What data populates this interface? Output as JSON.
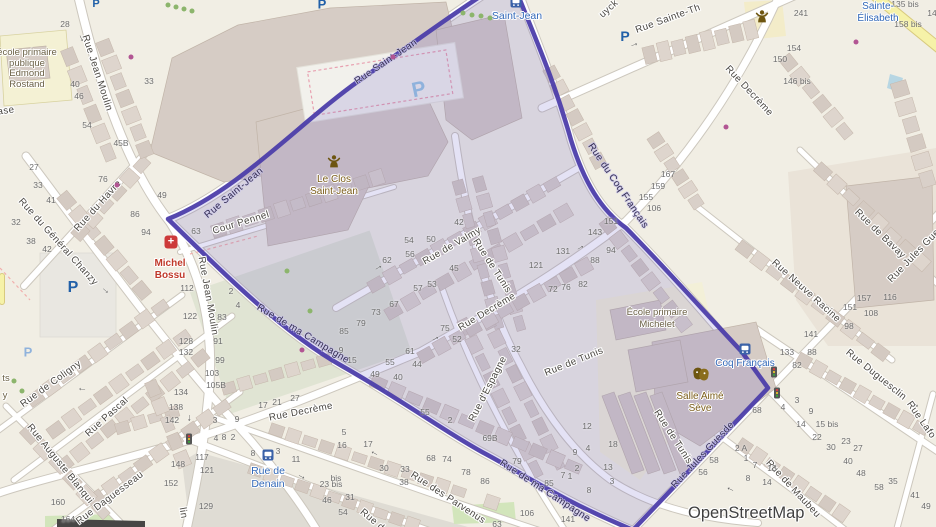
{
  "attribution": "OpenStreetMap",
  "colors": {
    "boundary": "#4c3eaa",
    "boundary_fill": "rgba(95,85,195,0.18)",
    "street": "#4a4742",
    "on_boundary": "#342e52",
    "number": "#6e6e6e",
    "transit": "#3268b8",
    "school": "#6b6146",
    "poi": "#7a5c18",
    "pharmacy": "#c0392b",
    "parking": "#2160a8",
    "parking_light": "#8fb2dc",
    "tree": "#8cb56c",
    "shop": "#b25593",
    "arrow": "#575757",
    "road": "#ffffff",
    "road_casing": "#ccc7bd",
    "building": "#d9d0c9",
    "yellow_road": "#f6f2a8",
    "water": "#b7d6e3"
  },
  "glyphs": {
    "parking": "P",
    "pharmacy_cross": "+",
    "arrow": "→"
  },
  "street_labels": [
    {
      "t": "Rue Jean Moulin",
      "x": 97,
      "y": 73,
      "r": 72
    },
    {
      "t": "Rue Jean Moulin",
      "x": 208,
      "y": 296,
      "r": 80
    },
    {
      "t": "lin",
      "x": 183,
      "y": 513,
      "r": 80
    },
    {
      "t": "Rue Saint-Jean",
      "x": 234,
      "y": 193,
      "r": -40,
      "k": "bd"
    },
    {
      "t": "Rue Saint-Jean",
      "x": 386,
      "y": 62,
      "r": -34,
      "k": "bd"
    },
    {
      "t": "Rue Sainte-Th",
      "x": 668,
      "y": 19,
      "r": -20
    },
    {
      "t": "uyck",
      "x": 609,
      "y": 9,
      "r": -42
    },
    {
      "t": "Rue Decrème",
      "x": 749,
      "y": 91,
      "r": 47
    },
    {
      "t": "Rue Decrème",
      "x": 487,
      "y": 312,
      "r": -31
    },
    {
      "t": "Rue Decrème",
      "x": 301,
      "y": 412,
      "r": -11
    },
    {
      "t": "Rue de Valmy",
      "x": 452,
      "y": 246,
      "r": -30
    },
    {
      "t": "Rue de Tunis",
      "x": 492,
      "y": 266,
      "r": 57
    },
    {
      "t": "Rue de Tunis",
      "x": 574,
      "y": 362,
      "r": -22
    },
    {
      "t": "Rue de Tunis",
      "x": 673,
      "y": 437,
      "r": 57
    },
    {
      "t": "Rue d'Espagne",
      "x": 488,
      "y": 389,
      "r": -63
    },
    {
      "t": "Cour Pennel",
      "x": 241,
      "y": 223,
      "r": -17
    },
    {
      "t": "Rue du Havre",
      "x": 98,
      "y": 206,
      "r": -48
    },
    {
      "t": "Rue du Général Chanzy",
      "x": 58,
      "y": 242,
      "r": 48
    },
    {
      "t": "Rue de Coligny",
      "x": 51,
      "y": 384,
      "r": -36
    },
    {
      "t": "Rue Pascal",
      "x": 107,
      "y": 417,
      "r": -42
    },
    {
      "t": "Rue Auguste Blanqui",
      "x": 60,
      "y": 464,
      "r": 51
    },
    {
      "t": "Rue Daguesseau",
      "x": 110,
      "y": 498,
      "r": -37
    },
    {
      "t": "Rue des Parvenus",
      "x": 448,
      "y": 498,
      "r": 33
    },
    {
      "t": "Rue Duguesclin",
      "x": 876,
      "y": 375,
      "r": 39
    },
    {
      "t": "Rue Lafo",
      "x": 921,
      "y": 420,
      "r": 55
    },
    {
      "t": "Rue de Maubeu",
      "x": 793,
      "y": 489,
      "r": 47
    },
    {
      "t": "Rue Neuve Racine",
      "x": 806,
      "y": 291,
      "r": 42
    },
    {
      "t": "Rue de Bavay",
      "x": 880,
      "y": 234,
      "r": 44
    },
    {
      "t": "Rue Jules Gue",
      "x": 914,
      "y": 256,
      "r": -46
    },
    {
      "t": "Rue de ma Campagne",
      "x": 303,
      "y": 334,
      "r": 31,
      "k": "bd"
    },
    {
      "t": "Rue de ma Campagne",
      "x": 545,
      "y": 491,
      "r": 33,
      "k": "bd"
    },
    {
      "t": "Rue du Coq Français",
      "x": 618,
      "y": 186,
      "r": 56,
      "k": "bd"
    },
    {
      "t": "Rue Jules Guesde",
      "x": 703,
      "y": 455,
      "r": -47,
      "k": "bd"
    },
    {
      "t": "Rue d",
      "x": 372,
      "y": 520,
      "r": 40
    },
    {
      "t": "ase",
      "x": 6,
      "y": 111,
      "r": -8
    }
  ],
  "house_numbers": [
    [
      "28",
      65,
      24
    ],
    [
      "33",
      149,
      81
    ],
    [
      "40",
      75,
      84
    ],
    [
      "46",
      79,
      96
    ],
    [
      "54",
      87,
      125
    ],
    [
      "45B",
      121,
      143
    ],
    [
      "27",
      34,
      167
    ],
    [
      "33",
      38,
      185
    ],
    [
      "41",
      51,
      200
    ],
    [
      "76",
      103,
      179
    ],
    [
      "49",
      162,
      195
    ],
    [
      "86",
      135,
      214
    ],
    [
      "94",
      146,
      232
    ],
    [
      "63",
      196,
      231
    ],
    [
      "32",
      16,
      222
    ],
    [
      "38",
      31,
      241
    ],
    [
      "42",
      47,
      249
    ],
    [
      "112",
      187,
      288
    ],
    [
      "122",
      190,
      316
    ],
    [
      "83",
      222,
      317
    ],
    [
      "128",
      186,
      341
    ],
    [
      "132",
      186,
      352
    ],
    [
      "2",
      231,
      291
    ],
    [
      "4",
      238,
      305
    ],
    [
      "91",
      218,
      341
    ],
    [
      "99",
      220,
      360
    ],
    [
      "103",
      212,
      373
    ],
    [
      "105B",
      216,
      385
    ],
    [
      "134",
      181,
      392
    ],
    [
      "138",
      176,
      407
    ],
    [
      "142",
      172,
      420
    ],
    [
      "148",
      178,
      464
    ],
    [
      "152",
      171,
      483
    ],
    [
      "160",
      58,
      502
    ],
    [
      "164",
      68,
      519
    ],
    [
      "117",
      202,
      457
    ],
    [
      "121",
      207,
      470
    ],
    [
      "129",
      206,
      506
    ],
    [
      "17",
      263,
      405
    ],
    [
      "21",
      277,
      402
    ],
    [
      "27",
      295,
      398
    ],
    [
      "3",
      215,
      420
    ],
    [
      "9",
      237,
      419
    ],
    [
      "4",
      216,
      438
    ],
    [
      "8",
      224,
      437
    ],
    [
      "2",
      233,
      437
    ],
    [
      "8",
      253,
      453
    ],
    [
      "3",
      278,
      451
    ],
    [
      "11",
      296,
      459
    ],
    [
      "23 bis",
      331,
      484
    ],
    [
      "46",
      327,
      500
    ],
    [
      "31",
      350,
      497
    ],
    [
      "54",
      343,
      512
    ],
    [
      "5",
      344,
      432
    ],
    [
      "16",
      342,
      445
    ],
    [
      "17",
      368,
      444
    ],
    [
      "30",
      384,
      468
    ],
    [
      "33",
      405,
      469
    ],
    [
      "38",
      404,
      482
    ],
    [
      "bis",
      336,
      478
    ],
    [
      "68",
      431,
      458
    ],
    [
      "74",
      447,
      459
    ],
    [
      "78",
      466,
      472
    ],
    [
      "86",
      485,
      481
    ],
    [
      "63",
      497,
      524
    ],
    [
      "106",
      527,
      513
    ],
    [
      "141",
      568,
      519
    ],
    [
      "42",
      459,
      222
    ],
    [
      "54",
      409,
      240
    ],
    [
      "50",
      431,
      239
    ],
    [
      "56",
      410,
      254
    ],
    [
      "62",
      387,
      260
    ],
    [
      "45",
      454,
      268
    ],
    [
      "57",
      418,
      288
    ],
    [
      "53",
      432,
      284
    ],
    [
      "67",
      394,
      304
    ],
    [
      "73",
      376,
      312
    ],
    [
      "79",
      361,
      323
    ],
    [
      "85",
      344,
      331
    ],
    [
      "9",
      341,
      350
    ],
    [
      "15",
      352,
      360
    ],
    [
      "55",
      390,
      362
    ],
    [
      "44",
      417,
      364
    ],
    [
      "49",
      375,
      374
    ],
    [
      "40",
      398,
      377
    ],
    [
      "75",
      445,
      328
    ],
    [
      "52",
      457,
      339
    ],
    [
      "61",
      410,
      351
    ],
    [
      "55",
      425,
      412
    ],
    [
      "2",
      450,
      420
    ],
    [
      "69B",
      490,
      438
    ],
    [
      "79",
      517,
      461
    ],
    [
      "85",
      549,
      483
    ],
    [
      "32",
      516,
      349
    ],
    [
      "12",
      587,
      426
    ],
    [
      "9",
      575,
      452
    ],
    [
      "4",
      588,
      448
    ],
    [
      "2",
      577,
      468
    ],
    [
      "1",
      570,
      476
    ],
    [
      "7",
      563,
      475
    ],
    [
      "18",
      613,
      444
    ],
    [
      "13",
      608,
      467
    ],
    [
      "3",
      612,
      481
    ],
    [
      "8",
      589,
      490
    ],
    [
      "167",
      668,
      174
    ],
    [
      "159",
      658,
      186
    ],
    [
      "155",
      646,
      197
    ],
    [
      "106",
      654,
      208
    ],
    [
      "151",
      611,
      221
    ],
    [
      "143",
      595,
      232
    ],
    [
      "131",
      563,
      251
    ],
    [
      "121",
      536,
      265
    ],
    [
      "94",
      611,
      250
    ],
    [
      "88",
      595,
      260
    ],
    [
      "82",
      583,
      284
    ],
    [
      "72",
      553,
      289
    ],
    [
      "76",
      566,
      287
    ],
    [
      "241",
      801,
      13
    ],
    [
      "154",
      794,
      48
    ],
    [
      "150",
      780,
      59
    ],
    [
      "146 bis",
      797,
      81
    ],
    [
      "135 bis",
      905,
      4
    ],
    [
      "14",
      932,
      13
    ],
    [
      "158 bis",
      908,
      24
    ],
    [
      "157",
      864,
      298
    ],
    [
      "151",
      850,
      307
    ],
    [
      "116",
      890,
      297
    ],
    [
      "108",
      871,
      313
    ],
    [
      "98",
      849,
      326
    ],
    [
      "141",
      811,
      334
    ],
    [
      "133",
      787,
      352
    ],
    [
      "88",
      812,
      352
    ],
    [
      "82",
      797,
      365
    ],
    [
      "68",
      757,
      410
    ],
    [
      "58",
      714,
      460
    ],
    [
      "56",
      703,
      472
    ],
    [
      "3",
      797,
      400
    ],
    [
      "4",
      783,
      407
    ],
    [
      "9",
      811,
      411
    ],
    [
      "14",
      801,
      424
    ],
    [
      "15 bis",
      827,
      424
    ],
    [
      "22",
      817,
      437
    ],
    [
      "23",
      846,
      441
    ],
    [
      "30",
      831,
      447
    ],
    [
      "27",
      858,
      448
    ],
    [
      "40",
      848,
      461
    ],
    [
      "48",
      861,
      473
    ],
    [
      "58",
      879,
      487
    ],
    [
      "35",
      893,
      481
    ],
    [
      "41",
      915,
      495
    ],
    [
      "49",
      926,
      506
    ],
    [
      "2 A",
      741,
      448
    ],
    [
      "1",
      746,
      458
    ],
    [
      "7",
      755,
      465
    ],
    [
      "8",
      748,
      478
    ],
    [
      "13",
      772,
      468
    ],
    [
      "14",
      767,
      482
    ]
  ],
  "pois": [
    {
      "lines": [
        "école primaire",
        "publique",
        "Edmond",
        "Rostand"
      ],
      "x": 27,
      "y": 48,
      "lh": 10.5,
      "c": "school",
      "s": 9.5
    },
    {
      "lines": [
        "École primaire",
        "Michelet"
      ],
      "x": 657,
      "y": 307,
      "lh": 11.5,
      "c": "school",
      "s": 9.5
    },
    {
      "lines": [
        "Le Clos",
        "Saint-Jean"
      ],
      "x": 334,
      "y": 174,
      "lh": 12,
      "c": "poi",
      "s": 10
    },
    {
      "lines": [
        "Michel",
        "Bossu"
      ],
      "x": 170,
      "y": 258,
      "lh": 11.5,
      "c": "pharmacy",
      "s": 10,
      "b": 1
    },
    {
      "lines": [
        "Salle Aimé",
        "Sève"
      ],
      "x": 700,
      "y": 391,
      "lh": 12,
      "c": "poi",
      "s": 10
    },
    {
      "lines": [
        "Sainte-",
        "Élisabeth"
      ],
      "x": 878,
      "y": 1,
      "lh": 11.5,
      "c": "transit",
      "s": 10
    },
    {
      "lines": [
        "Coq Français"
      ],
      "x": 745,
      "y": 358,
      "lh": 12,
      "c": "transit",
      "s": 10
    },
    {
      "lines": [
        "Rue de",
        "Denain"
      ],
      "x": 268,
      "y": 465,
      "lh": 12.5,
      "c": "transit",
      "s": 10.5
    },
    {
      "lines": [
        "Saint-Jean"
      ],
      "x": 517,
      "y": 10,
      "lh": 12,
      "c": "transit",
      "s": 10.5
    },
    {
      "lines": [
        "ts"
      ],
      "x": 6,
      "y": 373,
      "lh": 11,
      "c": "school",
      "s": 9.5
    },
    {
      "lines": [
        "y"
      ],
      "x": 5,
      "y": 390,
      "lh": 11,
      "c": "school",
      "s": 9.5
    }
  ],
  "icons": {
    "parking": [
      {
        "x": 322,
        "y": 4,
        "s": 13
      },
      {
        "x": 96,
        "y": 4,
        "s": 11
      },
      {
        "x": 625,
        "y": 36,
        "s": 14
      },
      {
        "x": 73,
        "y": 288,
        "s": 16
      },
      {
        "x": 28,
        "y": 352,
        "s": 13,
        "light": 1
      },
      {
        "x": 419,
        "y": 90,
        "s": 21,
        "light": 1,
        "r": -12
      }
    ],
    "pharmacy": [
      {
        "x": 171,
        "y": 242
      }
    ],
    "community": [
      {
        "x": 334,
        "y": 161
      },
      {
        "x": 762,
        "y": 16
      }
    ],
    "theatre": [
      {
        "x": 701,
        "y": 374
      }
    ],
    "transit": [
      {
        "x": 516,
        "y": 2
      },
      {
        "x": 745,
        "y": 349
      },
      {
        "x": 268,
        "y": 455
      }
    ],
    "traffic_lights": [
      {
        "x": 774,
        "y": 372
      },
      {
        "x": 777,
        "y": 393
      },
      {
        "x": 189,
        "y": 439
      }
    ]
  },
  "dots": {
    "trees": [
      [
        168,
        5
      ],
      [
        176,
        7
      ],
      [
        184,
        9
      ],
      [
        192,
        11
      ],
      [
        463,
        13
      ],
      [
        472,
        15
      ],
      [
        481,
        16
      ],
      [
        490,
        18
      ],
      [
        287,
        271
      ],
      [
        310,
        311
      ],
      [
        14,
        381
      ],
      [
        22,
        391
      ]
    ],
    "shops": [
      [
        131,
        57
      ],
      [
        117,
        185
      ],
      [
        393,
        57
      ],
      [
        726,
        127
      ],
      [
        856,
        42
      ],
      [
        302,
        350
      ]
    ]
  },
  "arrows": [
    [
      82,
      38,
      65
    ],
    [
      634,
      44,
      -18
    ],
    [
      916,
      404,
      38
    ],
    [
      302,
      476,
      28
    ],
    [
      374,
      454,
      208
    ],
    [
      190,
      418,
      90
    ],
    [
      435,
      338,
      -28
    ],
    [
      378,
      267,
      -30
    ],
    [
      106,
      290,
      42
    ],
    [
      82,
      390,
      185
    ],
    [
      730,
      490,
      205
    ],
    [
      580,
      247,
      -30
    ]
  ]
}
